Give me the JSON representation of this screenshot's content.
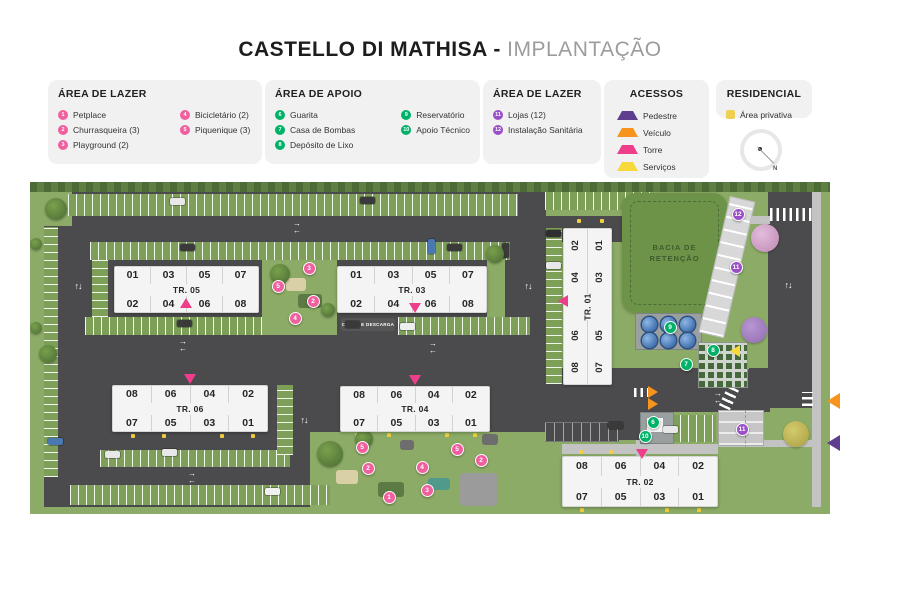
{
  "title": {
    "main": "CASTELLO DI MATHISA",
    "separator": " - ",
    "sub": "IMPLANTAÇÃO"
  },
  "colors": {
    "lazer": "#f0609f",
    "apoio": "#00b268",
    "lazer2": "#9a4fc8",
    "pedestre": "#5f3d8f",
    "veiculo": "#f7941e",
    "torre": "#ee3d8a",
    "servicos": "#f8d93c",
    "privativa": "#f0d052"
  },
  "legend_boxes": [
    {
      "title": "ÁREA DE LAZER",
      "group": "lazer",
      "columns": [
        [
          {
            "n": "1",
            "label": "Petplace"
          },
          {
            "n": "2",
            "label": "Churrasqueira (3)"
          },
          {
            "n": "3",
            "label": "Playground (2)"
          }
        ],
        [
          {
            "n": "4",
            "label": "Bicicletário (2)"
          },
          {
            "n": "5",
            "label": "Piquenique (3)"
          }
        ]
      ]
    },
    {
      "title": "ÁREA DE APOIO",
      "group": "apoio",
      "columns": [
        [
          {
            "n": "6",
            "label": "Guarita"
          },
          {
            "n": "7",
            "label": "Casa de Bombas"
          },
          {
            "n": "8",
            "label": "Depósito de Lixo"
          }
        ],
        [
          {
            "n": "9",
            "label": "Reservatório"
          },
          {
            "n": "10",
            "label": "Apoio Técnico"
          }
        ]
      ]
    },
    {
      "title": "ÁREA DE LAZER",
      "group": "lazer2",
      "columns": [
        [
          {
            "n": "11",
            "label": "Lojas (12)"
          },
          {
            "n": "12",
            "label": "Instalação Sanitária"
          }
        ]
      ]
    }
  ],
  "acessos": {
    "title": "ACESSOS",
    "items": [
      {
        "label": "Pedestre",
        "type": "pedestre"
      },
      {
        "label": "Veículo",
        "type": "veiculo"
      },
      {
        "label": "Torre",
        "type": "torre"
      },
      {
        "label": "Serviços",
        "type": "servicos"
      }
    ]
  },
  "residencial": {
    "title": "RESIDENCIAL",
    "label": "Área privativa"
  },
  "compass": {
    "label": "N"
  },
  "map": {
    "labels": {
      "bacia_line1": "BACIA DE",
      "bacia_line2": "RETENÇÃO",
      "carga": "CARGA E DESCARGA"
    },
    "buildings": [
      {
        "id": "tr05",
        "label": "TR. 05",
        "o": "h",
        "x": 84,
        "y": 84,
        "w": 145,
        "h": 47,
        "top": [
          "01",
          "03",
          "05",
          "07"
        ],
        "bottom": [
          "02",
          "04",
          "06",
          "08"
        ]
      },
      {
        "id": "tr03",
        "label": "TR. 03",
        "o": "h",
        "x": 307,
        "y": 84,
        "w": 150,
        "h": 47,
        "top": [
          "01",
          "03",
          "05",
          "07"
        ],
        "bottom": [
          "02",
          "04",
          "06",
          "08"
        ]
      },
      {
        "id": "tr01",
        "label": "TR. 01",
        "o": "v",
        "x": 533,
        "y": 46,
        "w": 49,
        "h": 157,
        "rows": [
          [
            "02",
            "01"
          ],
          [
            "04",
            "03"
          ],
          [
            "06",
            "05"
          ],
          [
            "08",
            "07"
          ]
        ]
      },
      {
        "id": "tr06",
        "label": "TR. 06",
        "o": "h",
        "x": 82,
        "y": 203,
        "w": 156,
        "h": 47,
        "top": [
          "08",
          "06",
          "04",
          "02"
        ],
        "bottom": [
          "07",
          "05",
          "03",
          "01"
        ]
      },
      {
        "id": "tr04",
        "label": "TR. 04",
        "o": "h",
        "x": 310,
        "y": 204,
        "w": 150,
        "h": 46,
        "top": [
          "08",
          "06",
          "04",
          "02"
        ],
        "bottom": [
          "07",
          "05",
          "03",
          "01"
        ]
      },
      {
        "id": "tr02",
        "label": "TR. 02",
        "o": "h",
        "x": 532,
        "y": 274,
        "w": 156,
        "h": 51,
        "top": [
          "08",
          "06",
          "04",
          "02"
        ],
        "bottom": [
          "07",
          "05",
          "03",
          "01"
        ]
      }
    ],
    "markers": [
      {
        "n": "3",
        "group": "lazer",
        "x": 279,
        "y": 86
      },
      {
        "n": "5",
        "group": "lazer",
        "x": 248,
        "y": 104
      },
      {
        "n": "2",
        "group": "lazer",
        "x": 283,
        "y": 119
      },
      {
        "n": "4",
        "group": "lazer",
        "x": 265,
        "y": 136
      },
      {
        "n": "5",
        "group": "lazer",
        "x": 332,
        "y": 265
      },
      {
        "n": "2",
        "group": "lazer",
        "x": 338,
        "y": 286
      },
      {
        "n": "1",
        "group": "lazer",
        "x": 359,
        "y": 315
      },
      {
        "n": "3",
        "group": "lazer",
        "x": 397,
        "y": 308
      },
      {
        "n": "4",
        "group": "lazer",
        "x": 392,
        "y": 285
      },
      {
        "n": "5",
        "group": "lazer",
        "x": 427,
        "y": 267
      },
      {
        "n": "2",
        "group": "lazer",
        "x": 451,
        "y": 278
      },
      {
        "n": "9",
        "group": "apoio",
        "x": 640,
        "y": 145
      },
      {
        "n": "8",
        "group": "apoio",
        "x": 683,
        "y": 168
      },
      {
        "n": "7",
        "group": "apoio",
        "x": 656,
        "y": 182
      },
      {
        "n": "6",
        "group": "apoio",
        "x": 623,
        "y": 240
      },
      {
        "n": "10",
        "group": "apoio",
        "x": 615,
        "y": 254
      },
      {
        "n": "12",
        "group": "lazer2",
        "x": 708,
        "y": 32
      },
      {
        "n": "11",
        "group": "lazer2",
        "x": 706,
        "y": 85
      },
      {
        "n": "11",
        "group": "lazer2",
        "x": 712,
        "y": 247
      }
    ],
    "access_points": [
      {
        "type": "torre",
        "dir": "up",
        "x": 156,
        "y": 121
      },
      {
        "type": "torre",
        "dir": "down",
        "x": 385,
        "y": 126
      },
      {
        "type": "torre",
        "dir": "left",
        "x": 534,
        "y": 118
      },
      {
        "type": "torre",
        "dir": "down",
        "x": 160,
        "y": 197
      },
      {
        "type": "torre",
        "dir": "down",
        "x": 385,
        "y": 198
      },
      {
        "type": "torre",
        "dir": "down",
        "x": 612,
        "y": 272
      },
      {
        "type": "veiculo",
        "dir": "right",
        "x": 624,
        "y": 209
      },
      {
        "type": "veiculo",
        "dir": "right",
        "x": 624,
        "y": 221
      },
      {
        "type": "servicos",
        "dir": "left",
        "x": 706,
        "y": 168
      }
    ],
    "arrows": [
      {
        "kind": "v",
        "x": 48,
        "y": 106
      },
      {
        "kind": "v",
        "x": 498,
        "y": 106
      },
      {
        "kind": "v",
        "x": 274,
        "y": 240
      },
      {
        "kind": "v",
        "x": 758,
        "y": 105
      },
      {
        "kind": "h",
        "x": 267,
        "y": 45
      },
      {
        "kind": "h",
        "x": 153,
        "y": 163
      },
      {
        "kind": "h",
        "x": 403,
        "y": 165
      },
      {
        "kind": "h",
        "x": 162,
        "y": 295
      },
      {
        "kind": "h",
        "x": 688,
        "y": 215
      }
    ],
    "edge_access": [
      {
        "type": "veiculo",
        "x": 827,
        "y": 393
      },
      {
        "type": "pedestre",
        "x": 827,
        "y": 435
      }
    ]
  }
}
